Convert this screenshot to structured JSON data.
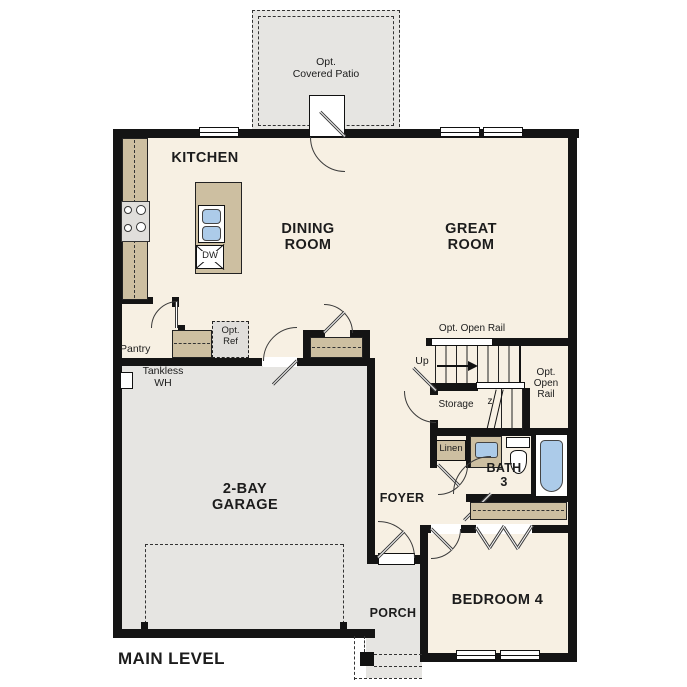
{
  "title": "MAIN LEVEL",
  "rooms": {
    "kitchen": "KITCHEN",
    "dining_room": "DINING\nROOM",
    "great_room": "GREAT\nROOM",
    "garage": "2-BAY\nGARAGE",
    "foyer": "FOYER",
    "bedroom_4": "BEDROOM 4",
    "bath_3": "BATH\n3",
    "porch": "PORCH",
    "pantry": "Pantry",
    "storage": "Storage",
    "linen": "Linen"
  },
  "annotations": {
    "covered_patio": "Opt.\nCovered Patio",
    "open_rail_top": "Opt. Open Rail",
    "open_rail_right": "Opt.\nOpen\nRail",
    "up": "Up",
    "opt_ref": "Opt.\nRef",
    "tankless_wh": "Tankless\nWH",
    "dishwasher": "DW",
    "stair_break": "z"
  },
  "colors": {
    "wall": "#141414",
    "floor": "#f7f0e3",
    "hard_floor": "#e6e5e2",
    "counter": "#cdbfa1",
    "fixture": "#accbe9",
    "appliance": "#e0dedb",
    "text": "#1c1c1c"
  }
}
